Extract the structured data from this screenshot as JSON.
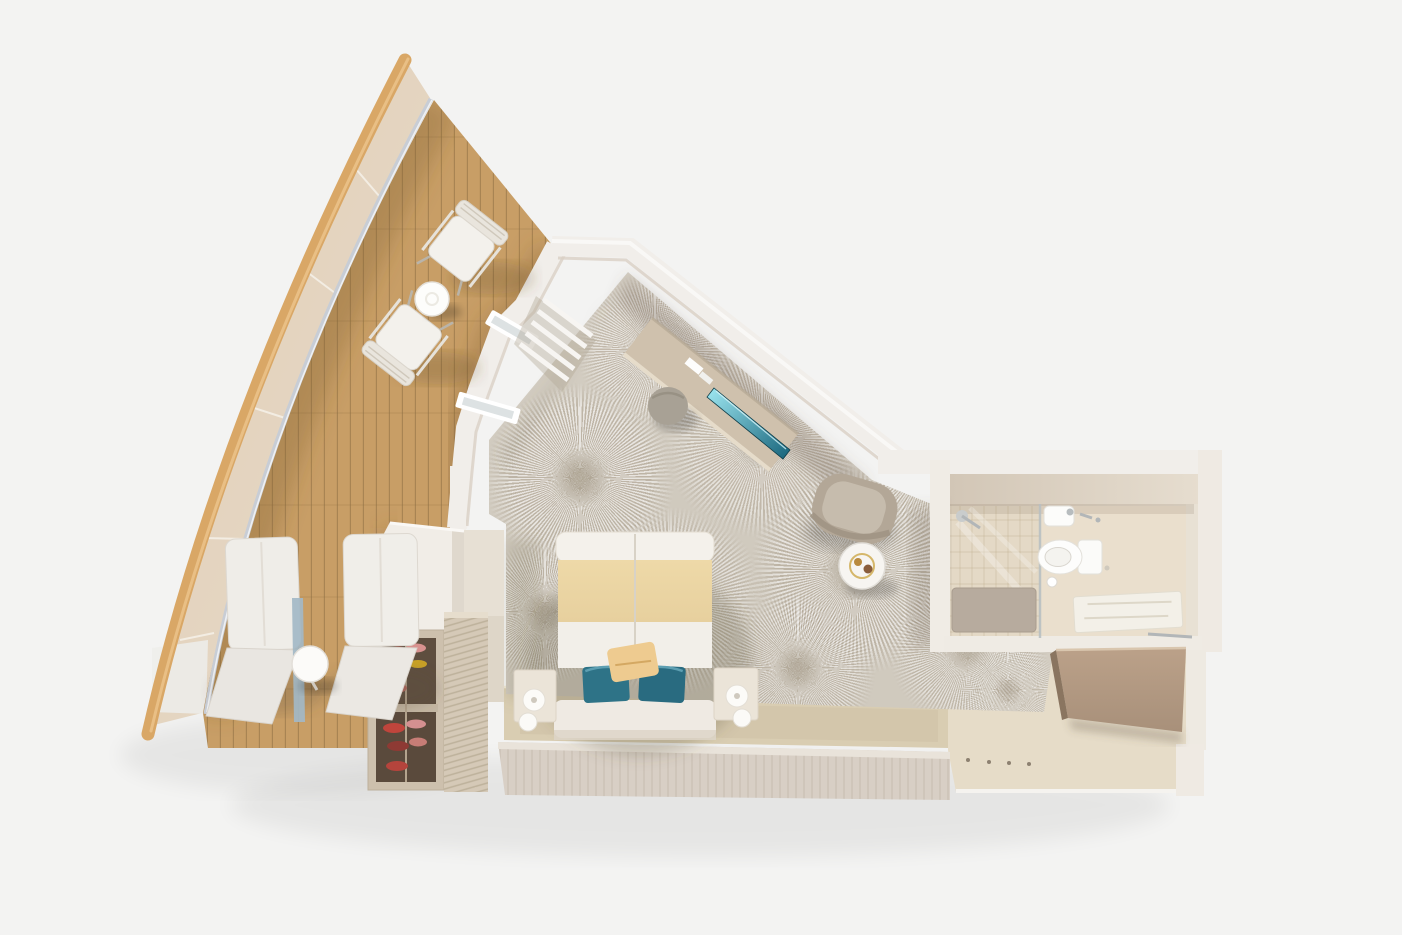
{
  "scene": {
    "type": "3d-floor-plan",
    "title": "Sail-shaped suite 3D floor plan",
    "description": "Top-down 3D cutaway rendering of a cruise-ship suite: triangular teak balcony inside a sail-shaped bow structure, bedroom with double bed and patterned carpet, media console with TV, armchair corner, bathroom with shower and toilet, and an entry corridor with wardrobe."
  },
  "palette": {
    "background": "#f3f3f2",
    "wall_white": "#f1eeea",
    "wall_inner_shade": "#d9d0c4",
    "sail_spar": "#d9a766",
    "sail_panel_light": "#e9dccb",
    "sail_panel_dark": "#dfcdb5",
    "rail_grey": "#c8cdd5",
    "deck_wood": "#c89e66",
    "deck_plank_line": "#8d6f42",
    "carpet_base": "#d7d1c6",
    "floor_platform": "#d9cdb2",
    "corridor_floor": "#e6dcc8",
    "bottom_wall_wood": "#d8cfc5",
    "bathroom_floor": "#eadfcd",
    "shower_mat": "#b7ab9e",
    "bed_white": "#f2efe9",
    "bed_gold": "#e7d09e",
    "teal_pillow": "#2e7387",
    "tan_pillow": "#eecb90",
    "tv_teal_light": "#9fe8f2",
    "tv_teal_dark": "#16637a",
    "dark_wood_panel": "#a8907a",
    "shoe_red": "#c2443c",
    "armchair_grey": "#b3a797",
    "stool_grey": "#a8a195"
  },
  "objects": {
    "sail": "Sail wing structure",
    "deck": "Teak balcony deck",
    "deck_chair": "Deck chair",
    "bistro_table": "Bistro table",
    "sun_lounger": "Sun lounger",
    "lounger_table": "Drinks table",
    "shoe_rack": "Shoe cabinet",
    "slat_wall": "Slatted partition",
    "closet": "Wardrobe unit",
    "bed": "Double bed",
    "nightstand": "Nightstand",
    "lamp": "Bedside lamp",
    "teal_pillow": "Teal accent pillow",
    "throw_pillow": "Throw pillow",
    "desk": "Media console",
    "tv": "Flat-screen TV",
    "stool": "Pouf stool",
    "armchair": "Armchair",
    "side_table": "Round side table",
    "carpet": "Starburst patterned carpet",
    "bathroom": "Bathroom",
    "shower": "Glass shower",
    "toilet": "Toilet",
    "sink": "Washbasin",
    "bath_mat": "Bath mat",
    "corridor": "Entry corridor",
    "corridor_wardrobe": "Corridor wardrobe",
    "window": "Forward window",
    "blinds": "Window blinds"
  }
}
